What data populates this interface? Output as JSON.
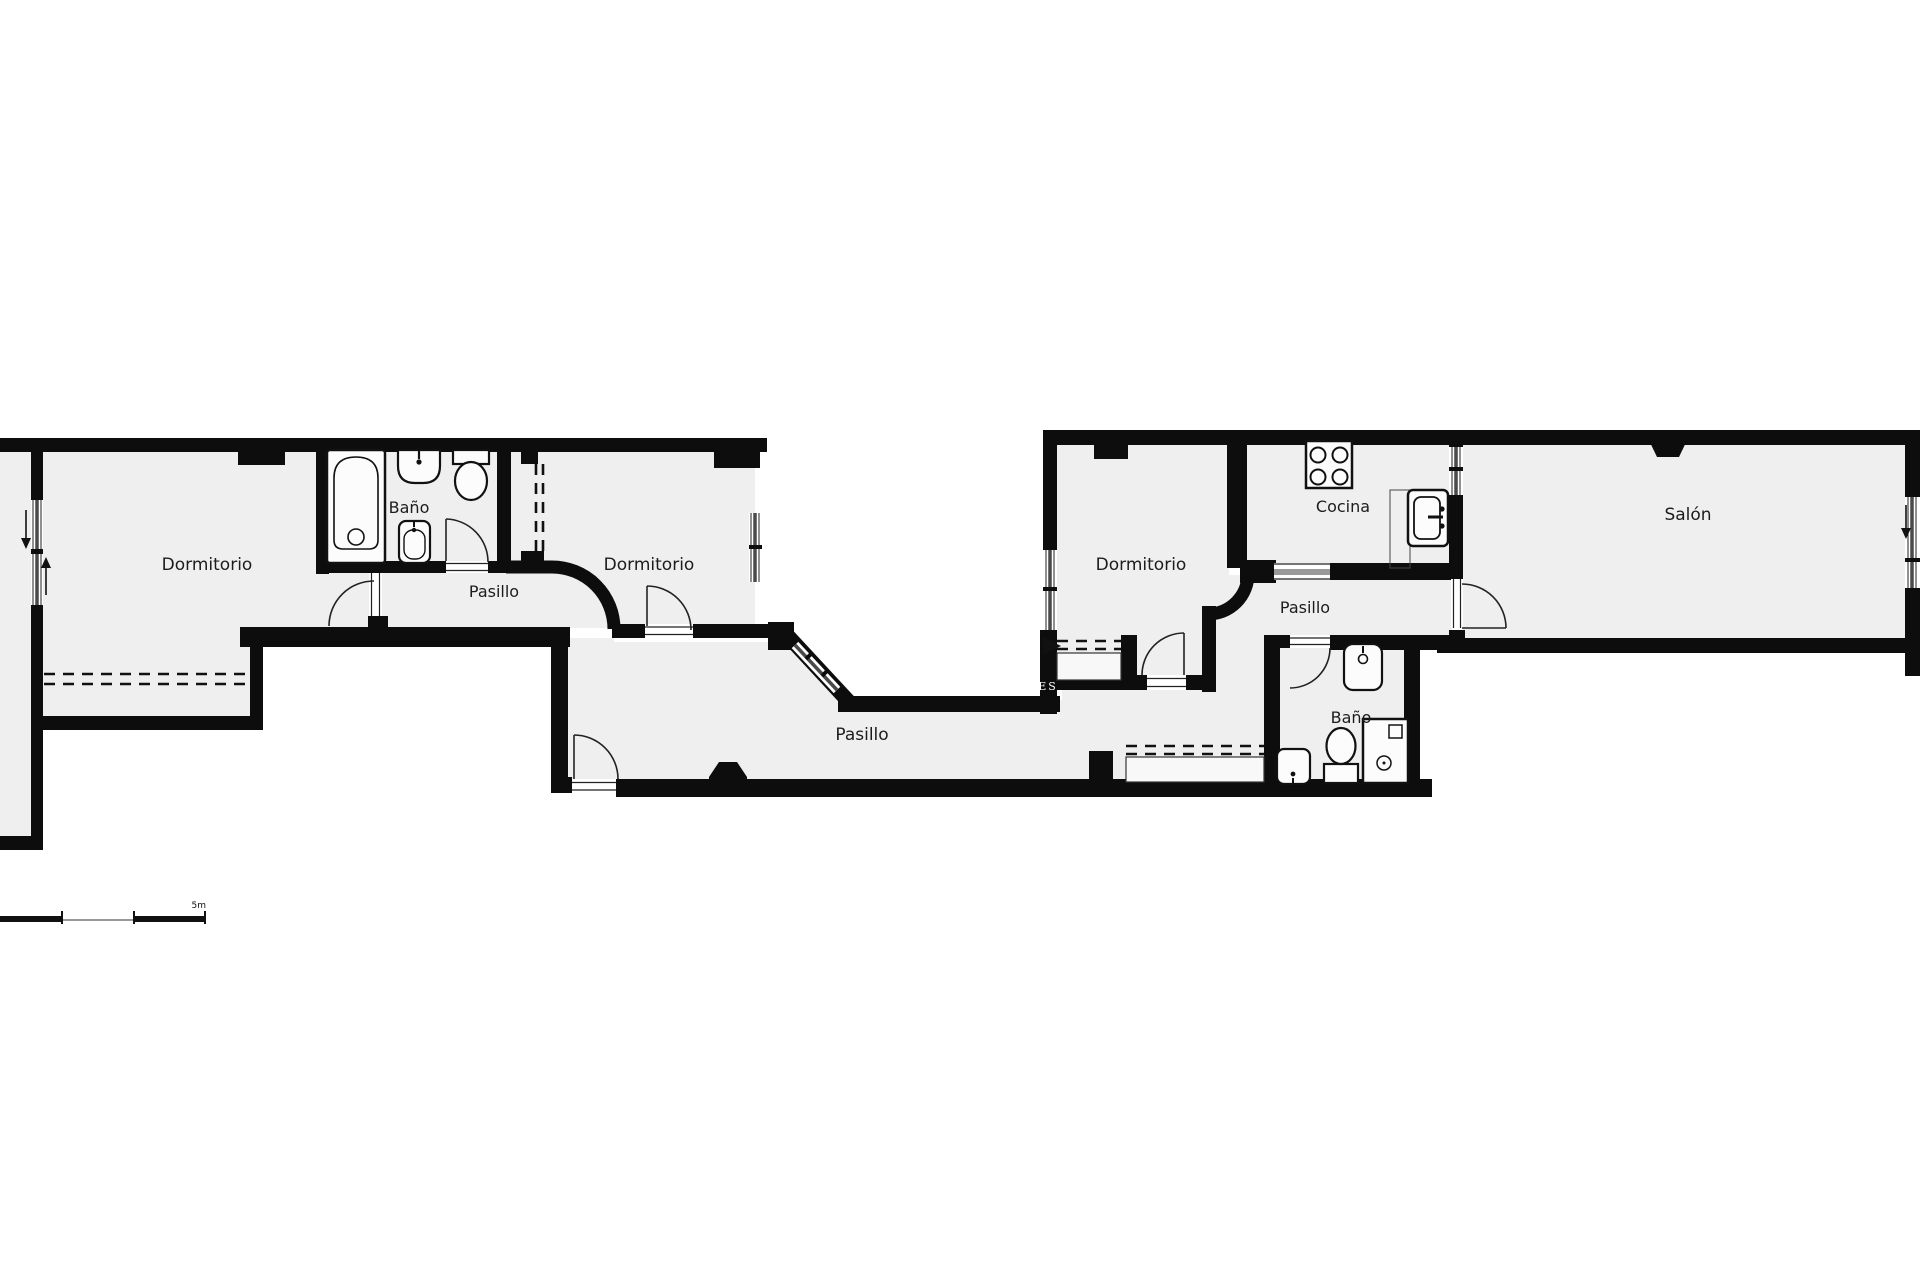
{
  "plan": {
    "type": "floorplan",
    "colors": {
      "wall": "#0d0d0d",
      "room_fill": "#efefef",
      "background": "#ffffff",
      "glass": "#4a4a4a"
    },
    "rooms": {
      "dormitorio_1": {
        "label": "Dormitorio"
      },
      "bano_1": {
        "label": "Baño"
      },
      "pasillo_1": {
        "label": "Pasillo"
      },
      "dormitorio_2": {
        "label": "Dormitorio"
      },
      "pasillo_main": {
        "label": "Pasillo"
      },
      "dormitorio_3": {
        "label": "Dormitorio"
      },
      "cocina": {
        "label": "Cocina"
      },
      "pasillo_3": {
        "label": "Pasillo"
      },
      "bano_2": {
        "label": "Baño"
      },
      "salon": {
        "label": "Salón"
      }
    },
    "markers": {
      "entrance": "ES",
      "scale": "5m"
    }
  }
}
